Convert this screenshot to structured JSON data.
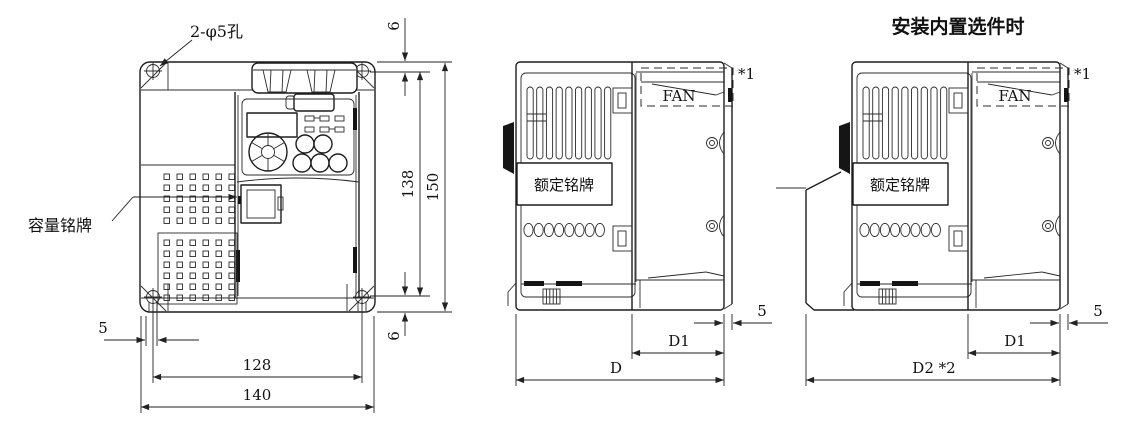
{
  "drawing": {
    "line_color": "#1d1d1d",
    "background": "#ffffff",
    "front_view": {
      "holes_label": "2-φ5孔",
      "capacity_nameplate_label": "容量铭牌",
      "dims": {
        "top_offset": "6",
        "hole_pitch_vertical": "138",
        "total_height": "150",
        "bottom_offset": "6",
        "edge_offset": "5",
        "hole_pitch_horizontal": "128",
        "total_width": "140"
      }
    },
    "side_view": {
      "rating_nameplate_label": "额定铭牌",
      "fan_label": "FAN",
      "note": "*1",
      "dims": {
        "rear_offset": "5",
        "panel_depth": "D1",
        "total_depth": "D"
      }
    },
    "option_view": {
      "title": "安装内置选件时",
      "rating_nameplate_label": "额定铭牌",
      "fan_label": "FAN",
      "note": "*1",
      "dims": {
        "rear_offset": "5",
        "panel_depth": "D1",
        "total_depth": "D2 *2"
      }
    }
  }
}
